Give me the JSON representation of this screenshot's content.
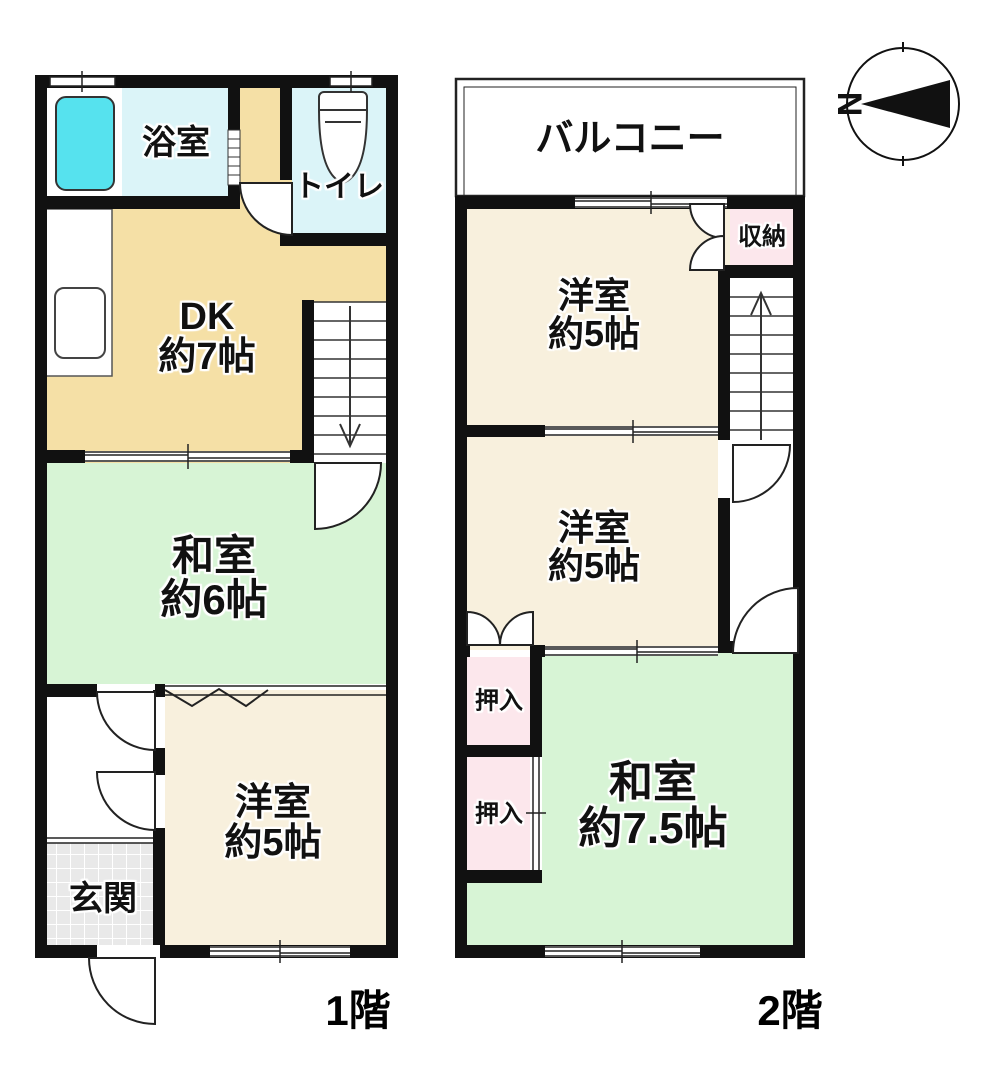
{
  "floor1": {
    "caption": "1階",
    "bath": {
      "name": "浴室"
    },
    "toilet": {
      "name": "トイレ"
    },
    "dk": {
      "name": "DK",
      "size": "約7帖"
    },
    "washitsu": {
      "name": "和室",
      "size": "約6帖"
    },
    "youshitsu": {
      "name": "洋室",
      "size": "約5帖"
    },
    "genkan": {
      "name": "玄関"
    }
  },
  "floor2": {
    "caption": "2階",
    "balcony": {
      "name": "バルコニー"
    },
    "youshitsu_north": {
      "name": "洋室",
      "size": "約5帖"
    },
    "storage": {
      "name": "収納"
    },
    "youshitsu_middle": {
      "name": "洋室",
      "size": "約5帖"
    },
    "oshiire_upper": {
      "name": "押入"
    },
    "oshiire_lower": {
      "name": "押入"
    },
    "washitsu": {
      "name": "和室",
      "size": "約7.5帖"
    }
  },
  "compass": {
    "north_label": "N"
  },
  "colors": {
    "wall": "#111111",
    "dk_tan": "#f5e0a6",
    "youshitsu_cream": "#f8f0dd",
    "washitsu_green": "#d7f4d5",
    "closet_pink": "#fce7ec",
    "bath_cyan": "#dbf4f8",
    "tub_cyan": "#56e2ee",
    "genkan_gray": "#e9e9e9"
  }
}
